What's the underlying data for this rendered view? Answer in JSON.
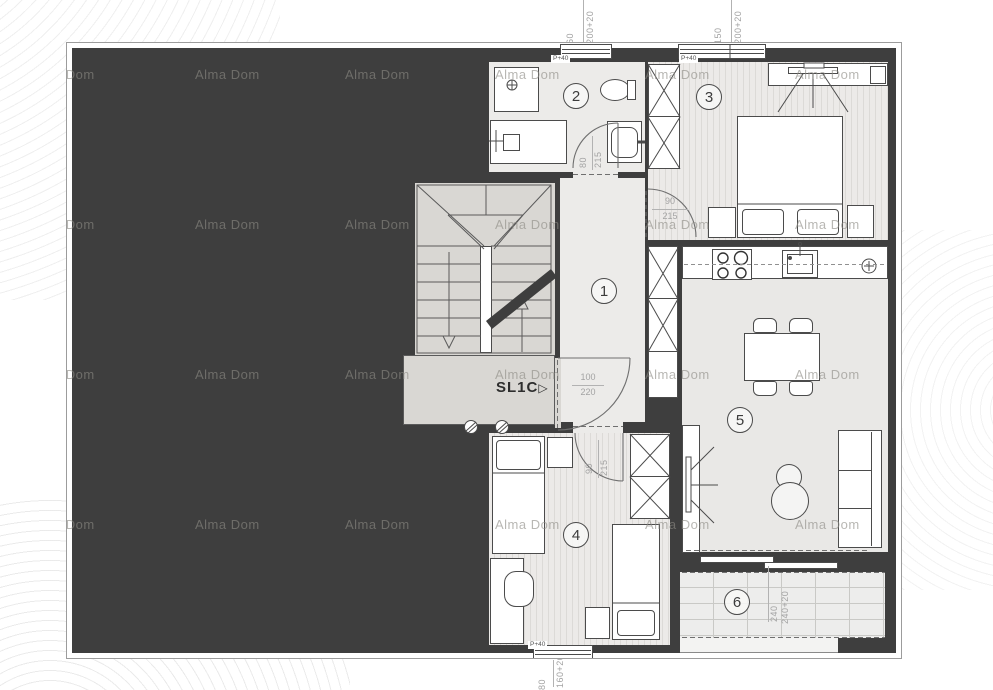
{
  "watermark": "Alma Dom",
  "rooms": [
    "1",
    "2",
    "3",
    "4",
    "5",
    "6"
  ],
  "stair": {
    "label": "SL1C",
    "arrow": "▷"
  },
  "doors": {
    "bath": {
      "w": "80",
      "h": "215"
    },
    "bed3": {
      "w": "90",
      "h": "215"
    },
    "entry": {
      "w": "100",
      "h": "220"
    },
    "bed4": {
      "w": "90",
      "h": "215"
    }
  },
  "window_label": "P+40",
  "dims": {
    "top_small": [
      "60",
      "200+20"
    ],
    "top_large": [
      "150",
      "200+20"
    ],
    "bottom": [
      "80",
      "160+20"
    ],
    "balcony": [
      "240",
      "240+20"
    ]
  },
  "colors": {
    "wall": "#3e3e3e",
    "floor_light": "#ecebe9",
    "floor_stairs": "#d9d7d3",
    "line": "#4b4b4b",
    "dim_text": "#a3a3a3"
  }
}
